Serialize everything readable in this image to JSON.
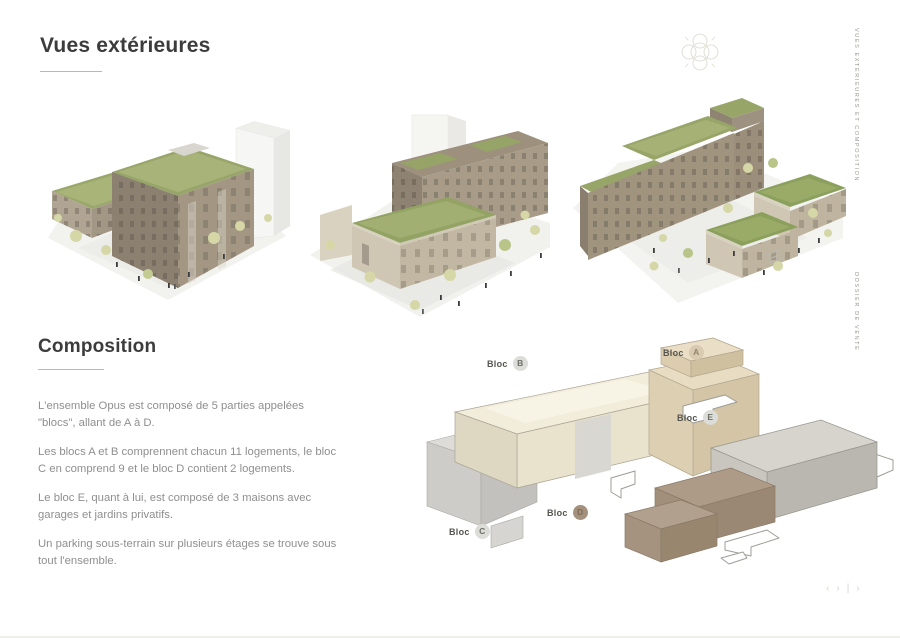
{
  "header": {
    "title": "Vues extérieures"
  },
  "composition": {
    "title": "Composition",
    "paragraphs": [
      "L'ensemble Opus est composé de 5 parties appelées \"blocs\", allant de A à D.",
      "Les blocs A et B comprennent chacun 11 logements, le bloc C en comprend 9 et le bloc D contient 2 logements.",
      "Le bloc E, quant à lui, est composé de 3 maisons avec garages et jardins privatifs.",
      "Un parking sous-terrain sur plusieurs étages se trouve sous tout l'ensemble."
    ]
  },
  "sidebar": {
    "top_label": "Vues extérieures et composition",
    "bottom_label": "Dossier de vente"
  },
  "diagram": {
    "blocks": [
      {
        "word": "Bloc",
        "letter": "B"
      },
      {
        "word": "Bloc",
        "letter": "A"
      },
      {
        "word": "Bloc",
        "letter": "E"
      },
      {
        "word": "Bloc",
        "letter": "D"
      },
      {
        "word": "Bloc",
        "letter": "C"
      }
    ]
  },
  "pagination": {
    "items": [
      "‹",
      "›",
      "|",
      "›"
    ]
  },
  "colors": {
    "heading_text": "#3c3c3c",
    "body_text": "#8f8f8f",
    "rule": "#b9b9ae",
    "cream_block": "#f2eddb",
    "tan_block": "#e8ddc3",
    "gray_block": "#d6d4cd",
    "brown_block": "#ad9a87",
    "green_roof": "#98a56a"
  }
}
